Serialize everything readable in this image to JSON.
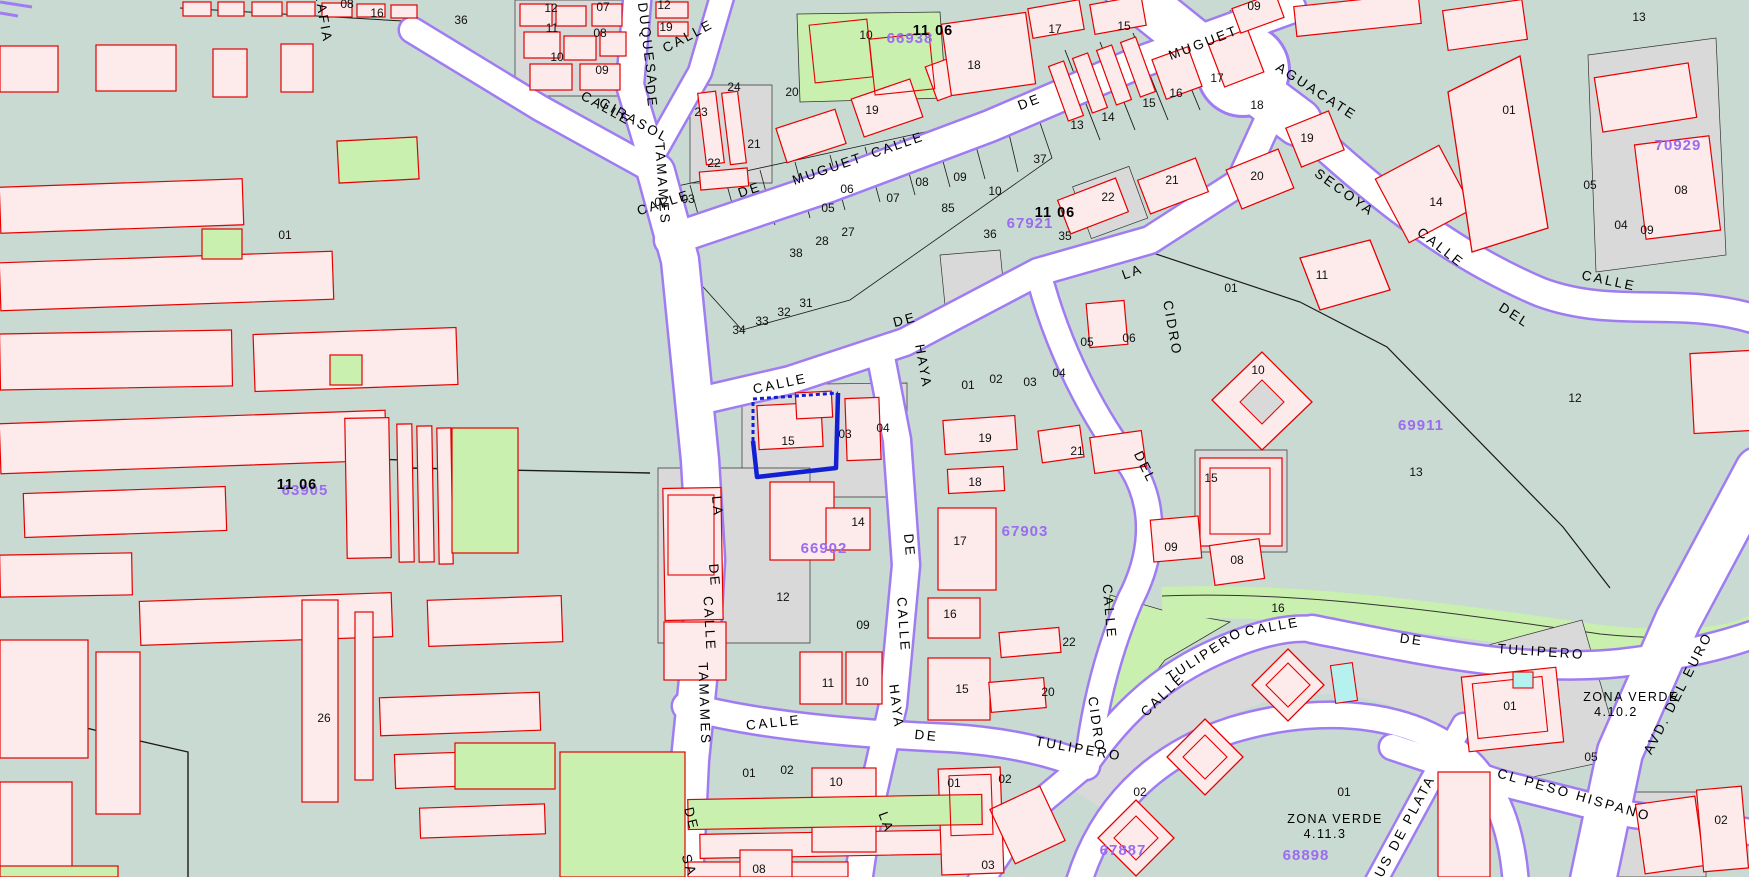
{
  "map": {
    "colors": {
      "background": "#c9dad2",
      "building_fill": "#fdeaea",
      "building_stroke": "#e60000",
      "parcel_grey": "#d9d9d9",
      "park_green": "#c9f0ae",
      "street_fill": "#ffffff",
      "street_casing": "#a07cf2",
      "code_purple": "#9b6cf0",
      "selection_blue": "#1320d2",
      "pool_cyan": "#b5f1ef",
      "boundary_black": "#1a1a1a"
    },
    "street_labels": [
      {
        "t": "RAFIA",
        "x": 319,
        "y": 18,
        "r": 80
      },
      {
        "t": "CALLE",
        "x": 690,
        "y": 40,
        "r": -28
      },
      {
        "t": "DUQUESA",
        "x": 643,
        "y": 45,
        "r": 83
      },
      {
        "t": "DE",
        "x": 647,
        "y": 97,
        "r": 83
      },
      {
        "t": "CALLE",
        "x": 604,
        "y": 112,
        "r": 29
      },
      {
        "t": "GIRASOL",
        "x": 632,
        "y": 124,
        "r": 29
      },
      {
        "t": "TAMAMES",
        "x": 658,
        "y": 184,
        "r": 86
      },
      {
        "t": "CALLE",
        "x": 665,
        "y": 207,
        "r": -18
      },
      {
        "t": "DE",
        "x": 751,
        "y": 194,
        "r": -18
      },
      {
        "t": "MUGUET",
        "x": 829,
        "y": 173,
        "r": -19
      },
      {
        "t": "CALLE",
        "x": 899,
        "y": 149,
        "r": -19
      },
      {
        "t": "DE",
        "x": 1031,
        "y": 106,
        "r": -21
      },
      {
        "t": "MUGUET",
        "x": 1205,
        "y": 47,
        "r": -21
      },
      {
        "t": "AGUACATE",
        "x": 1314,
        "y": 95,
        "r": 33
      },
      {
        "t": "SECOYA",
        "x": 1342,
        "y": 196,
        "r": 36
      },
      {
        "t": "CALLE",
        "x": 1438,
        "y": 251,
        "r": 38
      },
      {
        "t": "DEL",
        "x": 1512,
        "y": 319,
        "r": 33
      },
      {
        "t": "CALLE",
        "x": 1608,
        "y": 285,
        "r": 12
      },
      {
        "t": "CALLE",
        "x": 781,
        "y": 388,
        "r": -12
      },
      {
        "t": "DE",
        "x": 906,
        "y": 324,
        "r": -15
      },
      {
        "t": "HAYA",
        "x": 919,
        "y": 367,
        "r": 80
      },
      {
        "t": "LA",
        "x": 713,
        "y": 507,
        "r": 85
      },
      {
        "t": "DE",
        "x": 710,
        "y": 576,
        "r": 85
      },
      {
        "t": "CALLE",
        "x": 705,
        "y": 624,
        "r": 87
      },
      {
        "t": "TAMAMES",
        "x": 700,
        "y": 704,
        "r": 88
      },
      {
        "t": "DE",
        "x": 687,
        "y": 820,
        "r": 76
      },
      {
        "t": "SA",
        "x": 685,
        "y": 867,
        "r": 72
      },
      {
        "t": "DE",
        "x": 905,
        "y": 546,
        "r": 85
      },
      {
        "t": "CALLE",
        "x": 899,
        "y": 625,
        "r": 86
      },
      {
        "t": "HAYA",
        "x": 892,
        "y": 707,
        "r": 83
      },
      {
        "t": "LA",
        "x": 882,
        "y": 824,
        "r": 70
      },
      {
        "t": "LA",
        "x": 1134,
        "y": 276,
        "r": -20
      },
      {
        "t": "CIDRO",
        "x": 1168,
        "y": 329,
        "r": 80
      },
      {
        "t": "DEL",
        "x": 1141,
        "y": 469,
        "r": 64
      },
      {
        "t": "CALLE",
        "x": 1105,
        "y": 612,
        "r": 85
      },
      {
        "t": "CIDRO",
        "x": 1092,
        "y": 725,
        "r": 82
      },
      {
        "t": "CALLE",
        "x": 774,
        "y": 727,
        "r": -6
      },
      {
        "t": "DE",
        "x": 926,
        "y": 740,
        "r": 6
      },
      {
        "t": "TULIPERO",
        "x": 1078,
        "y": 753,
        "r": 10
      },
      {
        "t": "CALLE",
        "x": 1166,
        "y": 698,
        "r": -44
      },
      {
        "t": "TULIPERO",
        "x": 1207,
        "y": 658,
        "r": -33
      },
      {
        "t": "CALLE",
        "x": 1273,
        "y": 631,
        "r": -10
      },
      {
        "t": "DE",
        "x": 1411,
        "y": 644,
        "r": 8
      },
      {
        "t": "TULIPERO",
        "x": 1541,
        "y": 656,
        "r": 4
      },
      {
        "t": "SOUS DE PLATA",
        "x": 1403,
        "y": 839,
        "r": -62
      },
      {
        "t": "CL PESO HISPANO",
        "x": 1573,
        "y": 799,
        "r": 16
      },
      {
        "t": "AVD. DEL EURO",
        "x": 1682,
        "y": 695,
        "r": -63
      }
    ],
    "parcel_labels": [
      {
        "t": "36",
        "x": 461,
        "y": 24
      },
      {
        "t": "12",
        "x": 551,
        "y": 12
      },
      {
        "t": "11",
        "x": 552,
        "y": 32
      },
      {
        "t": "10",
        "x": 557,
        "y": 61
      },
      {
        "t": "07",
        "x": 603,
        "y": 11
      },
      {
        "t": "08",
        "x": 600,
        "y": 37
      },
      {
        "t": "09",
        "x": 602,
        "y": 74
      },
      {
        "t": "12",
        "x": 664,
        "y": 9
      },
      {
        "t": "19",
        "x": 666,
        "y": 31
      },
      {
        "t": "08",
        "x": 347,
        "y": 8
      },
      {
        "t": "16",
        "x": 377,
        "y": 17
      },
      {
        "t": "24",
        "x": 734,
        "y": 91
      },
      {
        "t": "23",
        "x": 701,
        "y": 116
      },
      {
        "t": "21",
        "x": 754,
        "y": 148
      },
      {
        "t": "22",
        "x": 714,
        "y": 167
      },
      {
        "t": "20",
        "x": 792,
        "y": 96
      },
      {
        "t": "10",
        "x": 866,
        "y": 39
      },
      {
        "t": "19",
        "x": 872,
        "y": 114
      },
      {
        "t": "18",
        "x": 974,
        "y": 69
      },
      {
        "t": "85",
        "x": 948,
        "y": 212
      },
      {
        "t": "38",
        "x": 796,
        "y": 257
      },
      {
        "t": "28",
        "x": 822,
        "y": 245
      },
      {
        "t": "27",
        "x": 848,
        "y": 236
      },
      {
        "t": "34",
        "x": 739,
        "y": 334
      },
      {
        "t": "33",
        "x": 762,
        "y": 325
      },
      {
        "t": "32",
        "x": 784,
        "y": 316
      },
      {
        "t": "31",
        "x": 806,
        "y": 307
      },
      {
        "t": "02",
        "x": 661,
        "y": 206
      },
      {
        "t": "03",
        "x": 688,
        "y": 203
      },
      {
        "t": "05",
        "x": 828,
        "y": 212
      },
      {
        "t": "06",
        "x": 847,
        "y": 193
      },
      {
        "t": "07",
        "x": 893,
        "y": 202
      },
      {
        "t": "08",
        "x": 922,
        "y": 186
      },
      {
        "t": "09",
        "x": 960,
        "y": 181
      },
      {
        "t": "10",
        "x": 995,
        "y": 195
      },
      {
        "t": "36",
        "x": 990,
        "y": 238
      },
      {
        "t": "37",
        "x": 1040,
        "y": 163
      },
      {
        "t": "35",
        "x": 1065,
        "y": 240
      },
      {
        "t": "22",
        "x": 1108,
        "y": 201
      },
      {
        "t": "21",
        "x": 1172,
        "y": 184
      },
      {
        "t": "20",
        "x": 1257,
        "y": 180
      },
      {
        "t": "19",
        "x": 1307,
        "y": 142
      },
      {
        "t": "13",
        "x": 1077,
        "y": 129
      },
      {
        "t": "14",
        "x": 1108,
        "y": 121
      },
      {
        "t": "15",
        "x": 1149,
        "y": 107
      },
      {
        "t": "16",
        "x": 1176,
        "y": 97
      },
      {
        "t": "17",
        "x": 1217,
        "y": 82
      },
      {
        "t": "18",
        "x": 1257,
        "y": 109
      },
      {
        "t": "17",
        "x": 1055,
        "y": 33
      },
      {
        "t": "15",
        "x": 1124,
        "y": 30
      },
      {
        "t": "09",
        "x": 1254,
        "y": 10
      },
      {
        "t": "01",
        "x": 1509,
        "y": 114
      },
      {
        "t": "13",
        "x": 1639,
        "y": 21
      },
      {
        "t": "05",
        "x": 1590,
        "y": 189
      },
      {
        "t": "04",
        "x": 1621,
        "y": 229
      },
      {
        "t": "09",
        "x": 1647,
        "y": 234
      },
      {
        "t": "08",
        "x": 1681,
        "y": 194
      },
      {
        "t": "14",
        "x": 1436,
        "y": 206
      },
      {
        "t": "12",
        "x": 1575,
        "y": 402
      },
      {
        "t": "13",
        "x": 1416,
        "y": 476
      },
      {
        "t": "15",
        "x": 1211,
        "y": 482
      },
      {
        "t": "10",
        "x": 1258,
        "y": 374
      },
      {
        "t": "11",
        "x": 1322,
        "y": 279
      },
      {
        "t": "01",
        "x": 1231,
        "y": 292
      },
      {
        "t": "06",
        "x": 1129,
        "y": 342
      },
      {
        "t": "05",
        "x": 1087,
        "y": 346
      },
      {
        "t": "04",
        "x": 1059,
        "y": 377
      },
      {
        "t": "03",
        "x": 1030,
        "y": 386
      },
      {
        "t": "02",
        "x": 996,
        "y": 383
      },
      {
        "t": "01",
        "x": 968,
        "y": 389
      },
      {
        "t": "15",
        "x": 788,
        "y": 445
      },
      {
        "t": "03",
        "x": 845,
        "y": 438
      },
      {
        "t": "04",
        "x": 883,
        "y": 432
      },
      {
        "t": "19",
        "x": 985,
        "y": 442
      },
      {
        "t": "21",
        "x": 1077,
        "y": 455
      },
      {
        "t": "18",
        "x": 975,
        "y": 486
      },
      {
        "t": "17",
        "x": 960,
        "y": 545
      },
      {
        "t": "14",
        "x": 858,
        "y": 526
      },
      {
        "t": "09",
        "x": 1171,
        "y": 551
      },
      {
        "t": "08",
        "x": 1237,
        "y": 564
      },
      {
        "t": "12",
        "x": 783,
        "y": 601
      },
      {
        "t": "09",
        "x": 863,
        "y": 629
      },
      {
        "t": "11",
        "x": 828,
        "y": 687
      },
      {
        "t": "10",
        "x": 862,
        "y": 686
      },
      {
        "t": "16",
        "x": 950,
        "y": 618
      },
      {
        "t": "15",
        "x": 962,
        "y": 693
      },
      {
        "t": "22",
        "x": 1069,
        "y": 646
      },
      {
        "t": "20",
        "x": 1048,
        "y": 696
      },
      {
        "t": "16",
        "x": 1278,
        "y": 612
      },
      {
        "t": "02",
        "x": 1005,
        "y": 783
      },
      {
        "t": "01",
        "x": 749,
        "y": 777
      },
      {
        "t": "02",
        "x": 787,
        "y": 774
      },
      {
        "t": "10",
        "x": 836,
        "y": 786
      },
      {
        "t": "01",
        "x": 954,
        "y": 787
      },
      {
        "t": "03",
        "x": 988,
        "y": 869
      },
      {
        "t": "08",
        "x": 759,
        "y": 873
      },
      {
        "t": "02",
        "x": 1140,
        "y": 796
      },
      {
        "t": "01",
        "x": 1344,
        "y": 796
      },
      {
        "t": "05",
        "x": 1591,
        "y": 761
      },
      {
        "t": "01",
        "x": 1510,
        "y": 710
      },
      {
        "t": "02",
        "x": 1721,
        "y": 824
      },
      {
        "t": "26",
        "x": 324,
        "y": 722
      },
      {
        "t": "01",
        "x": 285,
        "y": 239
      }
    ],
    "zone_codes": [
      {
        "t": "66938",
        "x": 910,
        "y": 43
      },
      {
        "t": "67921",
        "x": 1030,
        "y": 228
      },
      {
        "t": "63905",
        "x": 305,
        "y": 495
      },
      {
        "t": "66902",
        "x": 824,
        "y": 553
      },
      {
        "t": "67903",
        "x": 1025,
        "y": 536
      },
      {
        "t": "69911",
        "x": 1421,
        "y": 430
      },
      {
        "t": "70929",
        "x": 1678,
        "y": 150
      },
      {
        "t": "68898",
        "x": 1306,
        "y": 860
      },
      {
        "t": "67887",
        "x": 1123,
        "y": 855
      }
    ],
    "sector_labels": [
      {
        "t": "11 06",
        "x": 933,
        "y": 35
      },
      {
        "t": "11 06",
        "x": 1055,
        "y": 217
      },
      {
        "t": "11 06",
        "x": 297,
        "y": 489
      }
    ],
    "area_labels": [
      {
        "t": "ZONA VERDE",
        "x": 1631,
        "y": 701
      },
      {
        "t": "4.10.2",
        "x": 1616,
        "y": 716
      },
      {
        "t": "ZONA VERDE",
        "x": 1335,
        "y": 823
      },
      {
        "t": "4.11.3",
        "x": 1325,
        "y": 838
      }
    ],
    "selection": {
      "parcel": "15"
    }
  }
}
